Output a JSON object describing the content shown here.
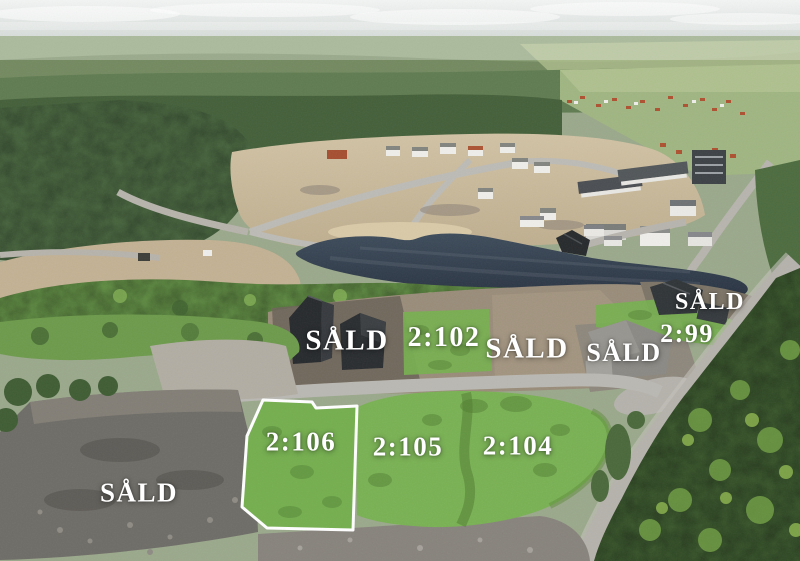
{
  "scene": {
    "type": "aerial-drone-photo",
    "description": "Aerial view of a hillside housing development: forest, pond, new construction lots and roads. Available lots are highlighted green with lot numbers; sold lots are marked SÅLD.",
    "colors": {
      "sky": "#e7ebe8",
      "distant_hills": "#879a79",
      "field_green": "#abbc8a",
      "forest_dark": "#3e5c33",
      "forest_mid": "#547046",
      "shrub_green": "#699746",
      "sand": "#c9b99b",
      "dirt_lot": "#94876f",
      "gravel_light": "#b3afa7",
      "gravel_dark": "#6c6a64",
      "road": "#b8b6b0",
      "pond": "#313d4b",
      "overlay_green": "#76b04f",
      "overlay_green_dark": "#4e7a2e",
      "lot_outline": "#ffffff",
      "house_dark": "#2c2f31",
      "house_white": "#f0efec",
      "roof_grey": "#8a8884",
      "roof_red": "#ad5130",
      "label_text": "#ffffff"
    }
  },
  "labels": {
    "items": [
      {
        "id": "sald-west",
        "text": "SÅLD"
      },
      {
        "id": "lot-2-102",
        "text": "2:102"
      },
      {
        "id": "sald-middle",
        "text": "SÅLD"
      },
      {
        "id": "sald-northeast",
        "text": "SÅLD"
      },
      {
        "id": "lot-2-99",
        "text": "2:99"
      },
      {
        "id": "sald-east",
        "text": "SÅLD"
      },
      {
        "id": "lot-2-106",
        "text": "2:106"
      },
      {
        "id": "lot-2-105",
        "text": "2:105"
      },
      {
        "id": "lot-2-104",
        "text": "2:104"
      },
      {
        "id": "sald-southwest",
        "text": "SÅLD"
      }
    ]
  }
}
